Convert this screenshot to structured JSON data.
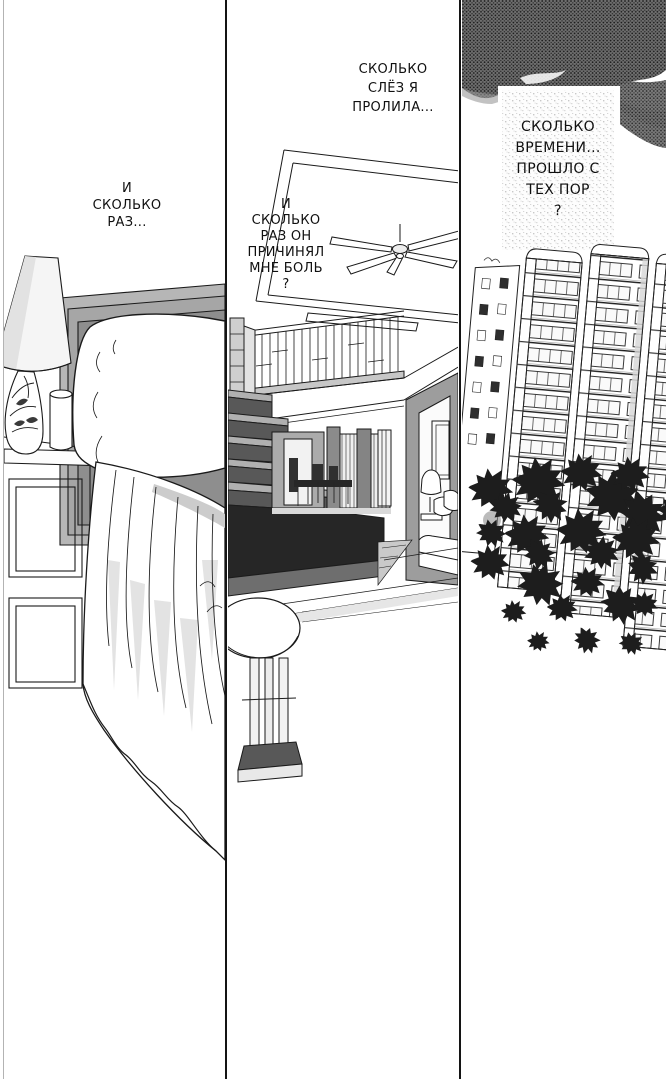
{
  "page": {
    "kind": "manga page",
    "language": "Russian",
    "background_color": "#ffffff",
    "ink_color": "#141414"
  },
  "tones": {
    "headboard_gray": "#a6a6a6",
    "stair_dark": "#262626",
    "sky_dark_tone": "#4a4a4a",
    "speckle_tone": "#e6e6e6"
  },
  "panels": [
    {
      "name": "bedroom",
      "alt": "Bed with large white pillow, dark toned headboard, draped sheets, nightstand with table lamp, plant vase and cup",
      "dialogue": {
        "text": "И\nСКОЛЬКО\nРАЗ..."
      }
    },
    {
      "name": "living-room",
      "alt": "Double-height living room with ceiling fan, balcony railing, staircase, dining table and chairs, sofa with lamp, round side table",
      "dialogue_top": {
        "text": "СКОЛЬКО\nСЛЁЗ Я\nПРОЛИЛА..."
      },
      "dialogue_main": {
        "text": "И\nСКОЛЬКО\nРАЗ ОН\nПРИЧИНЯЛ\nМНЕ БОЛЬ\n?"
      }
    },
    {
      "name": "city",
      "alt": "Tall apartment towers leaning under a dark stormy sky, scattered trees below",
      "dialogue": {
        "text": "СКОЛЬКО\nВРЕМЕНИ...\nПРОШЛО С\nТЕХ ПОР\n?"
      }
    }
  ]
}
